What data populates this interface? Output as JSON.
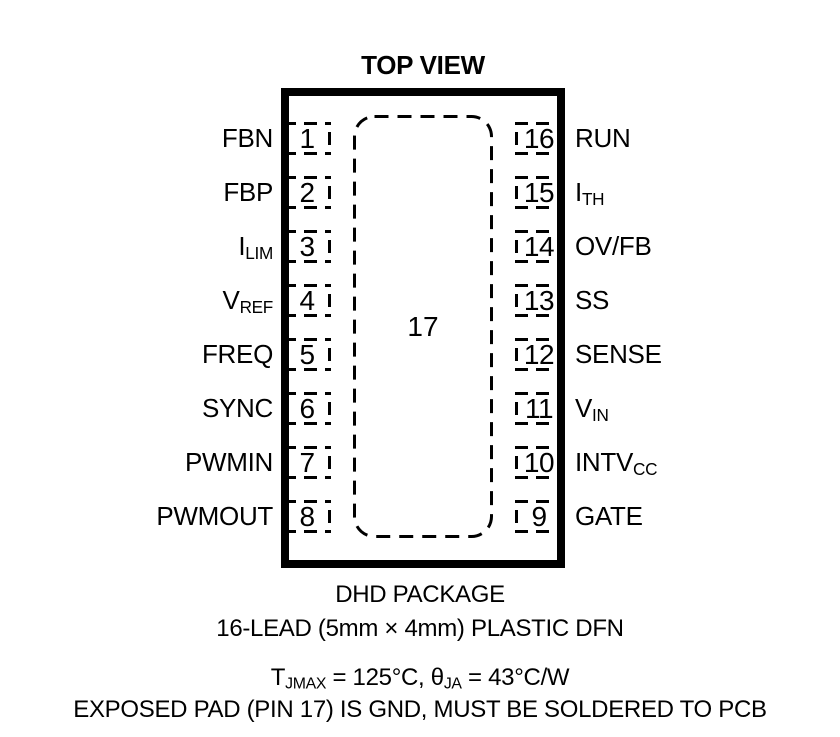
{
  "title": "TOP VIEW",
  "colors": {
    "ink": "#000000",
    "background": "#ffffff"
  },
  "package": {
    "center_pad": {
      "number": "17"
    },
    "left_pins": [
      {
        "number": "1",
        "label_main": "FBN",
        "label_sub": ""
      },
      {
        "number": "2",
        "label_main": "FBP",
        "label_sub": ""
      },
      {
        "number": "3",
        "label_main": "I",
        "label_sub": "LIM"
      },
      {
        "number": "4",
        "label_main": "V",
        "label_sub": "REF"
      },
      {
        "number": "5",
        "label_main": "FREQ",
        "label_sub": ""
      },
      {
        "number": "6",
        "label_main": "SYNC",
        "label_sub": ""
      },
      {
        "number": "7",
        "label_main": "PWMIN",
        "label_sub": ""
      },
      {
        "number": "8",
        "label_main": "PWMOUT",
        "label_sub": ""
      }
    ],
    "right_pins": [
      {
        "number": "16",
        "label_main": "RUN",
        "label_sub": ""
      },
      {
        "number": "15",
        "label_main": "I",
        "label_sub": "TH"
      },
      {
        "number": "14",
        "label_main": "OV/FB",
        "label_sub": ""
      },
      {
        "number": "13",
        "label_main": "SS",
        "label_sub": ""
      },
      {
        "number": "12",
        "label_main": "SENSE",
        "label_sub": ""
      },
      {
        "number": "11",
        "label_main": "V",
        "label_sub": "IN"
      },
      {
        "number": "10",
        "label_main": "INTV",
        "label_sub": "CC"
      },
      {
        "number": "9",
        "label_main": "GATE",
        "label_sub": ""
      }
    ]
  },
  "captions": {
    "package_name": "DHD PACKAGE",
    "package_desc": "16-LEAD (5mm × 4mm) PLASTIC DFN",
    "thermal": {
      "t1": "T",
      "sub1": "JMAX",
      "t2": " = 125°C, θ",
      "sub2": "JA",
      "t3": " = 43°C/W"
    },
    "note": "EXPOSED PAD (PIN 17) IS GND, MUST BE SOLDERED TO PCB"
  }
}
